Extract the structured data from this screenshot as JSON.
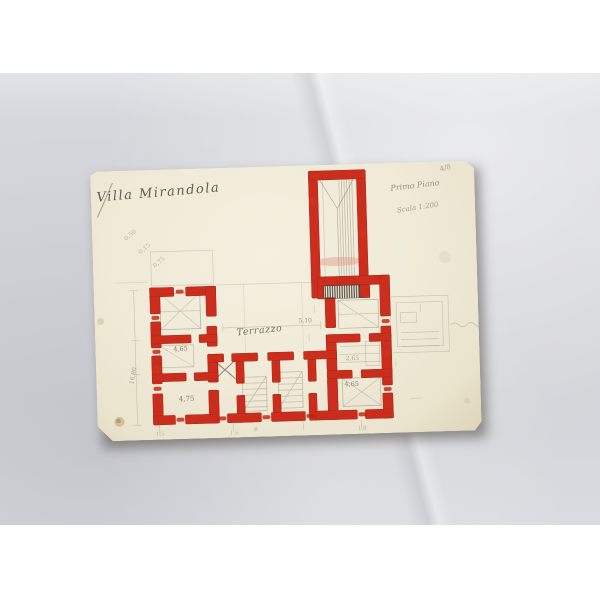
{
  "photo": {
    "background_color": "#ffffff",
    "backdrop_color": "#d6d7dc",
    "paper_color": "#efe9d6",
    "wall_red": "#c81e0e",
    "pencil_gray": "#8a8376"
  },
  "drawing": {
    "title": "Villa Mirandola",
    "corner_mark": "4/8",
    "heading_right_line1": "Primo Piano",
    "heading_right_line2": "Scala 1:200",
    "terrace_label": "Terrazzo",
    "dimensions": {
      "courtyard": "5,10",
      "left_room_mid": "4,65",
      "left_room_bottom": "4,75",
      "right_room_mid": "2,65",
      "right_room_bottom": "4,65",
      "left_margin_total": "16,80"
    },
    "calc_notes": [
      "0,50",
      "0,15",
      "0,75"
    ],
    "base_ticks": [
      "1,5",
      "1,6",
      "1,8"
    ]
  }
}
